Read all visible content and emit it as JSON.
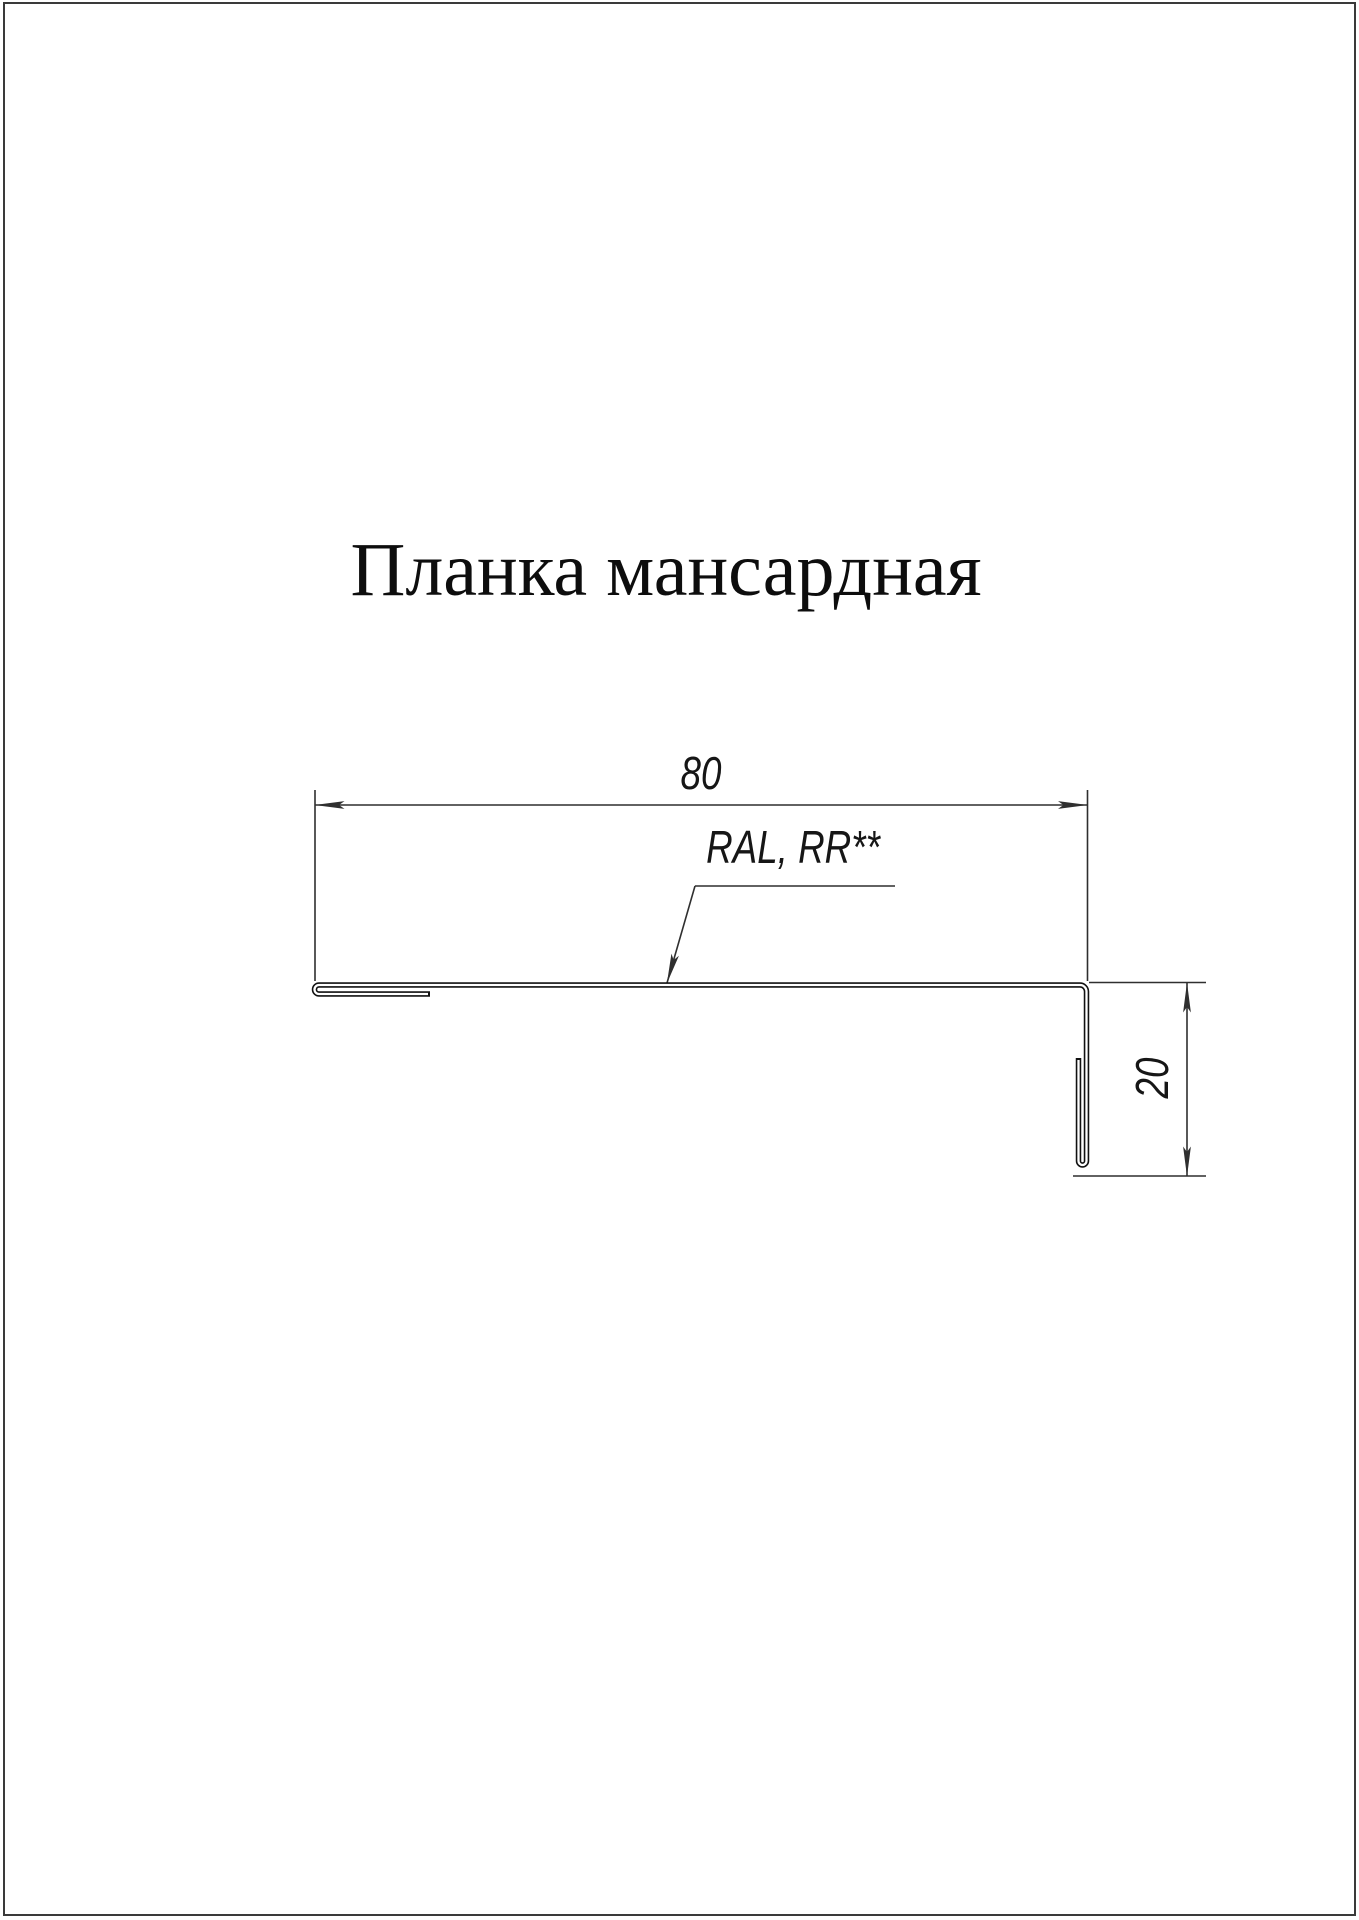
{
  "title": "Планка мансардная",
  "dimensions": {
    "width_label": "80",
    "height_label": "20"
  },
  "coating_label": "RAL, RR**",
  "colors": {
    "background": "#ffffff",
    "page_border": "#3a3a3a",
    "thin_line": "#2f2f2f",
    "metal_line": "#111111",
    "text": "#0d0d0d"
  }
}
